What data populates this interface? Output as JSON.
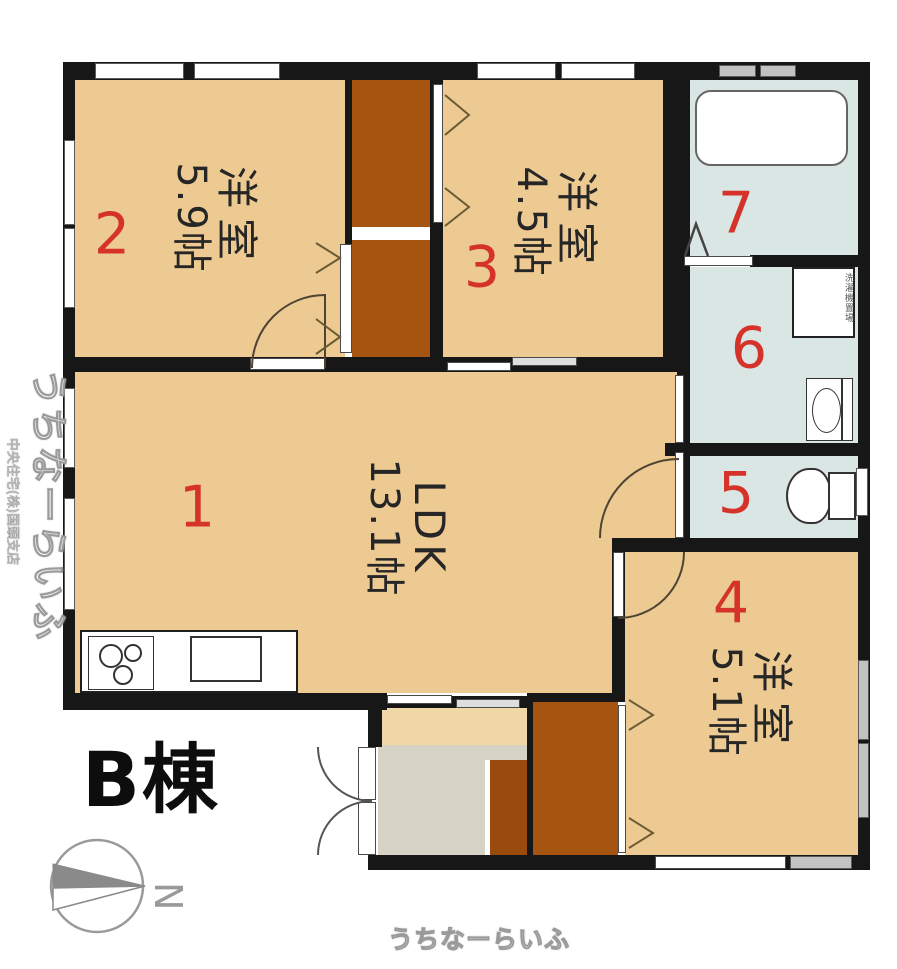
{
  "building_label": "B棟",
  "compass": {
    "letter": "N"
  },
  "rooms": {
    "ldk": {
      "number": "1",
      "name": "LDK",
      "size": "13.1帖"
    },
    "bedroom_a": {
      "number": "2",
      "name": "洋室",
      "size": "5.9帖"
    },
    "bedroom_b": {
      "number": "3",
      "name": "洋室",
      "size": "4.5帖"
    },
    "bedroom_c": {
      "number": "4",
      "name": "洋室",
      "size": "5.1帖"
    },
    "toilet": {
      "number": "5"
    },
    "washroom": {
      "number": "6",
      "washer_label": "洗濯機置場"
    },
    "bathroom": {
      "number": "7"
    }
  },
  "watermarks": {
    "bottom": "うちなーらいふ",
    "side_main": "うちなーらいふ",
    "side_sub": "中央住宅(株)国頭支店"
  },
  "colors": {
    "floor_tan": "#ecca92",
    "hall_tan": "#efd8a6",
    "genkan_gray": "#d6d2c6",
    "wet_blue": "#d9e6e4",
    "closet_brown": "#a5550f",
    "closet_brown_dark": "#9a4a0c",
    "wall_black": "#171717",
    "number_red": "#d5332a"
  }
}
